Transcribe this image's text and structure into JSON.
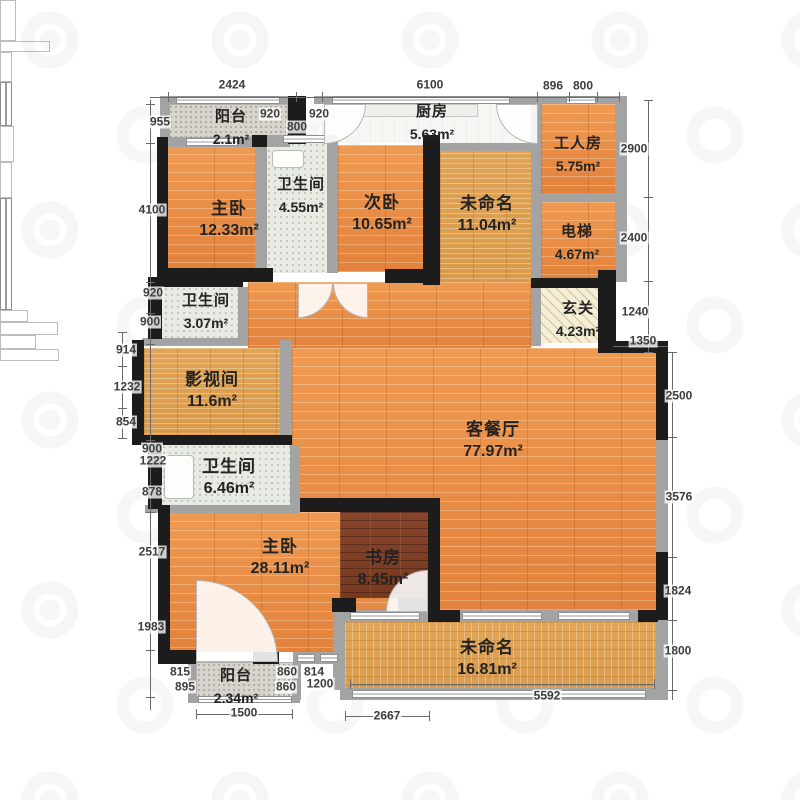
{
  "plan_title": "apartment-floor-plan",
  "rooms": [
    {
      "id": "balcony-top",
      "name": "阳台",
      "area": "2.1m²"
    },
    {
      "id": "master-bedroom-top",
      "name": "主卧",
      "area": "12.33m²"
    },
    {
      "id": "bathroom-top",
      "name": "卫生间",
      "area": "4.55m²"
    },
    {
      "id": "second-bedroom",
      "name": "次卧",
      "area": "10.65m²"
    },
    {
      "id": "kitchen",
      "name": "厨房",
      "area": "5.63m²"
    },
    {
      "id": "unnamed-top",
      "name": "未命名",
      "area": "11.04m²"
    },
    {
      "id": "worker-room",
      "name": "工人房",
      "area": "5.75m²"
    },
    {
      "id": "elevator",
      "name": "电梯",
      "area": "4.67m²"
    },
    {
      "id": "entry-hall",
      "name": "玄关",
      "area": "4.23m²"
    },
    {
      "id": "bathroom-mid",
      "name": "卫生间",
      "area": "3.07m²"
    },
    {
      "id": "media-room",
      "name": "影视间",
      "area": "11.6m²"
    },
    {
      "id": "bathroom-low",
      "name": "卫生间",
      "area": "6.46m²"
    },
    {
      "id": "living-dining",
      "name": "客餐厅",
      "area": "77.97m²"
    },
    {
      "id": "master-bedroom-bottom",
      "name": "主卧",
      "area": "28.11m²"
    },
    {
      "id": "study",
      "name": "书房",
      "area": "8.45m²"
    },
    {
      "id": "balcony-bottom",
      "name": "阳台",
      "area": "2.34m²"
    },
    {
      "id": "unnamed-bottom",
      "name": "未命名",
      "area": "16.81m²"
    }
  ],
  "dims": [
    {
      "v": "2424"
    },
    {
      "v": "6100"
    },
    {
      "v": "896"
    },
    {
      "v": "800"
    },
    {
      "v": "920"
    },
    {
      "v": "800"
    },
    {
      "v": "920"
    },
    {
      "v": "955"
    },
    {
      "v": "4100"
    },
    {
      "v": "920"
    },
    {
      "v": "900"
    },
    {
      "v": "914"
    },
    {
      "v": "1232"
    },
    {
      "v": "854"
    },
    {
      "v": "900"
    },
    {
      "v": "1222"
    },
    {
      "v": "878"
    },
    {
      "v": "2517"
    },
    {
      "v": "1983"
    },
    {
      "v": "815"
    },
    {
      "v": "895"
    },
    {
      "v": "1500"
    },
    {
      "v": "860"
    },
    {
      "v": "814"
    },
    {
      "v": "860"
    },
    {
      "v": "1200"
    },
    {
      "v": "2667"
    },
    {
      "v": "5592"
    },
    {
      "v": "2900"
    },
    {
      "v": "2400"
    },
    {
      "v": "1240"
    },
    {
      "v": "1350"
    },
    {
      "v": "2500"
    },
    {
      "v": "3576"
    },
    {
      "v": "1824"
    },
    {
      "v": "1800"
    }
  ]
}
